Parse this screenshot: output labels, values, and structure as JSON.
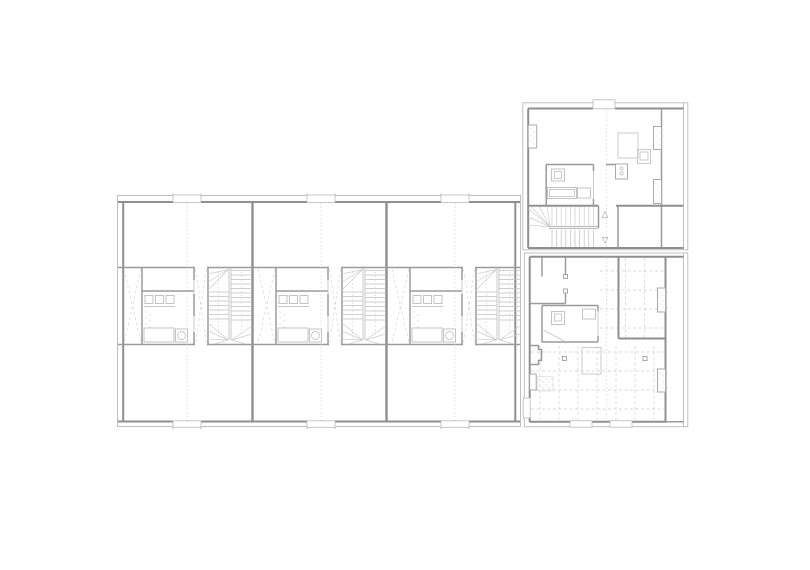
{
  "drawing": {
    "title": "Residential floor plan",
    "kind": "architectural line drawing, grey on white"
  },
  "markers": {
    "up_glyph": "△",
    "down_glyph": "▽"
  },
  "colors": {
    "background": "#ffffff",
    "wall_cut": "#8f8f8f",
    "wall_interior": "#9a9a9a",
    "facade_line": "#b9b9b9",
    "fixture_line": "#c3c3c3",
    "stair_tread": "#bfbfbf",
    "grid_dash": "#cdcdcd",
    "centerline_dot": "#cfcfcf",
    "hatch_dot": "#c2c2c2"
  },
  "buildings": {
    "row_wing": {
      "units": 3,
      "parts": [
        "upper room",
        "entry strip",
        "kitchen-bath core",
        "corridor",
        "double winder stair",
        "lower room"
      ]
    },
    "upper_point_house": {
      "parts": [
        "two rooms",
        "bathroom",
        "kitchen",
        "stair with up-down markers",
        "loggia strip"
      ]
    },
    "lower_point_house": {
      "parts": [
        "entry rooms",
        "bathroom",
        "large open room with joist grid",
        "loggia strip"
      ]
    }
  }
}
